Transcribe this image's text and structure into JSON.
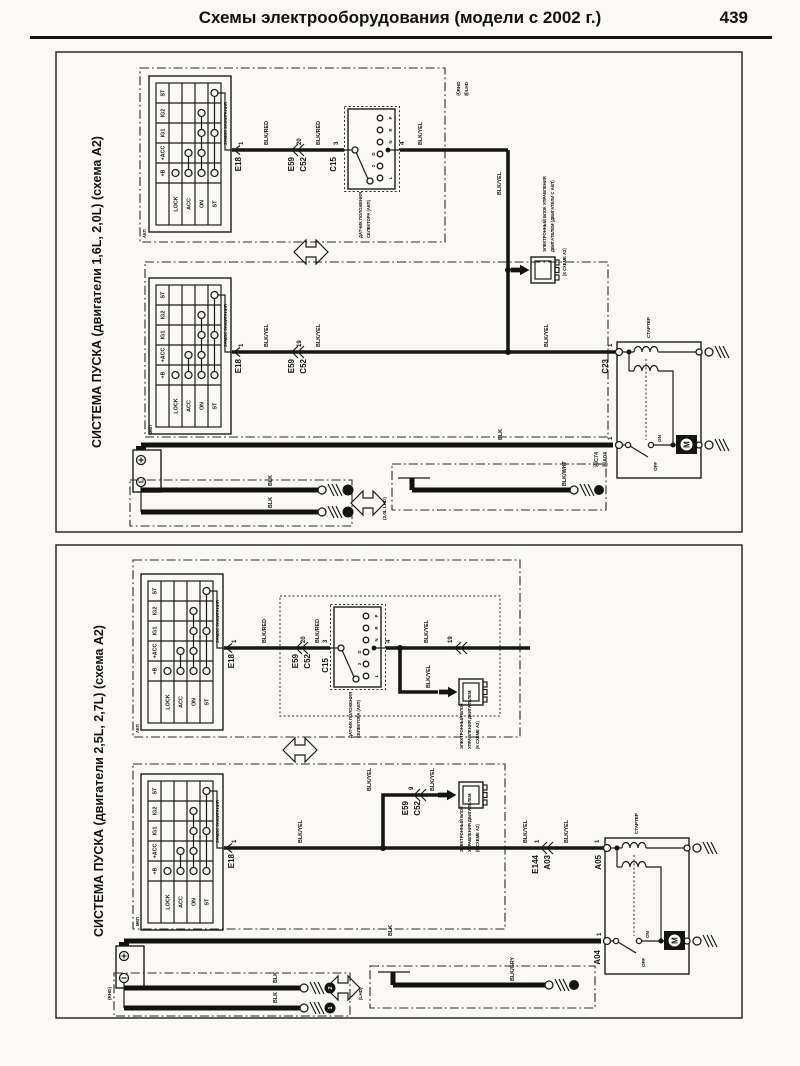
{
  "header": {
    "title": "Схемы электрооборудования (модели с 2002 г.)",
    "page": "439"
  },
  "shared": {
    "ignition": {
      "name": "ЗАМОК ЗАЖИГАНИЯ",
      "terminals": [
        "ST",
        "IG2",
        "IG1",
        "+ACC",
        "+B"
      ],
      "positions": [
        "LOCK",
        "ACC",
        "ON",
        "ST"
      ]
    },
    "selector": {
      "id": "C15",
      "caption_l1": "ДАТЧИК ПОЛОЖЕНИЯ",
      "caption_l2": "СЕЛЕКТОРА (АКП)",
      "gears": [
        "P",
        "R",
        "N",
        "D",
        "2",
        "L"
      ]
    },
    "starter": {
      "name": "СТАРТЕР",
      "off": "OFF",
      "on": "ON",
      "motor": "M"
    },
    "ecu_long": {
      "l1": "ЭЛЕКТРОННЫЙ БЛОК УПРАВЛЕНИЯ",
      "l2": "ДВИГАТЕЛЕМ (ДВИГАТЕЛИ С АКП)",
      "ref": "(К СХЕМЕ А2)"
    },
    "ecu_short": {
      "l1": "ЭЛЕКТРОННЫЙ БЛОК",
      "l2": "УПРАВЛЕНИЯ ДВИГАТЕЛЕМ",
      "ref": "(К СХЕМЕ А2)"
    },
    "wires": {
      "blk_red": "BLK/RED",
      "blk_yel": "BLK/YEL",
      "blk": "BLK",
      "blk_wht": "BLK/WHT",
      "blk_gry": "BLK/GRY"
    },
    "variants": {
      "akp": "АКП",
      "mkp": "МКП"
    }
  },
  "panel1": {
    "title": "СИСТЕМА ПУСКА (двигатели 1,6L, 2,0L) (схема А2)",
    "markers": {
      "rhd": "ⒶRHD",
      "lhd": "ⒷLHD"
    },
    "conn": {
      "e18": "E18",
      "e59": "E59",
      "c52": "C52",
      "c23": "C23",
      "c74": "ⒶC74",
      "a04": "ⒷA04"
    },
    "pins": {
      "p1": "1",
      "p20": "20",
      "p3": "3",
      "p4": "4",
      "p19": "19"
    },
    "lhd_note": "(2,0L LHD)"
  },
  "panel2": {
    "title": "СИСТЕМА ПУСКА (двигатели 2,5L, 2,7L) (схема А2)",
    "conn": {
      "e18": "E18",
      "e59": "E59",
      "c52": "C52",
      "e144": "E144",
      "a03": "A03",
      "a05": "A05",
      "a04": "A04"
    },
    "pins": {
      "p1": "1",
      "p20": "20",
      "p3": "3",
      "p4": "4",
      "p19": "19",
      "p9": "9"
    },
    "rhd": "(RHD)",
    "lhd": "(LHD)",
    "gnd_marks": {
      "g1": "1",
      "g2": "2"
    }
  }
}
